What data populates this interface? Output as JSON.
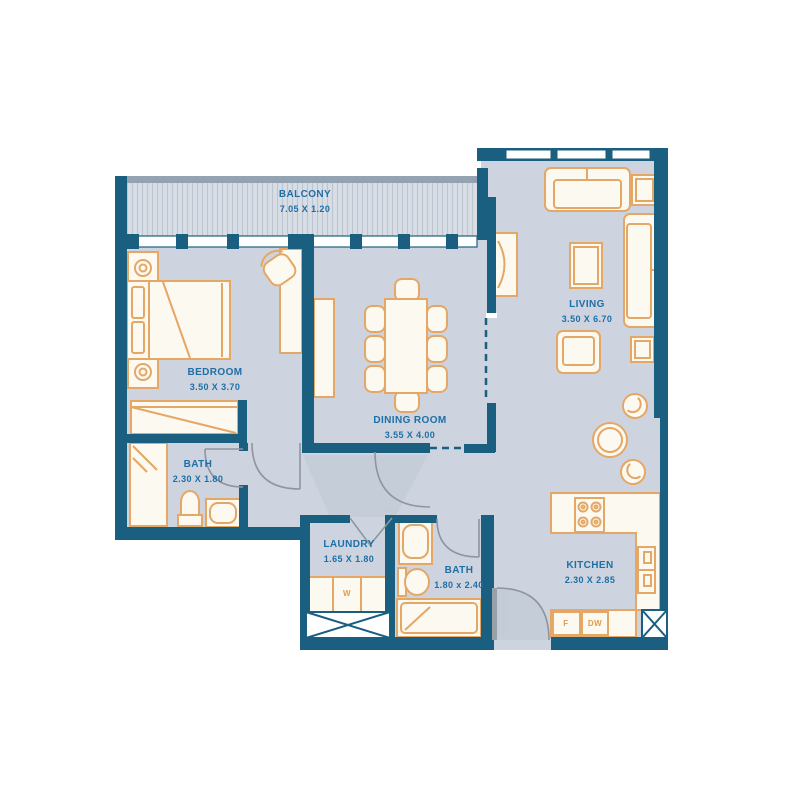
{
  "plan": {
    "rooms": {
      "balcony": {
        "name": "BALCONY",
        "dims": "7.05 X 1.20"
      },
      "bedroom": {
        "name": "BEDROOM",
        "dims": "3.50 X 3.70"
      },
      "dining": {
        "name": "DINING ROOM",
        "dims": "3.55 X 4.00"
      },
      "living": {
        "name": "LIVING",
        "dims": "3.50 X 6.70"
      },
      "bath1": {
        "name": "BATH",
        "dims": "2.30 X 1.80"
      },
      "laundry": {
        "name": "LAUNDRY",
        "dims": "1.65 X 1.80"
      },
      "bath2": {
        "name": "BATH",
        "dims": "1.80 x 2.40"
      },
      "kitchen": {
        "name": "KITCHEN",
        "dims": "2.30 X 2.85"
      }
    },
    "appliances": {
      "washer": "W",
      "fridge": "F",
      "dishwasher": "DW"
    },
    "colors": {
      "wall": "#1a5f80",
      "floor": "#cdd4df",
      "balcony_fill": "#d9dee6",
      "furniture_outline": "#e5a765",
      "furniture_fill": "#fcf9f1",
      "label_text": "#1e6fa6",
      "appliance_text": "#e39b4a"
    }
  }
}
